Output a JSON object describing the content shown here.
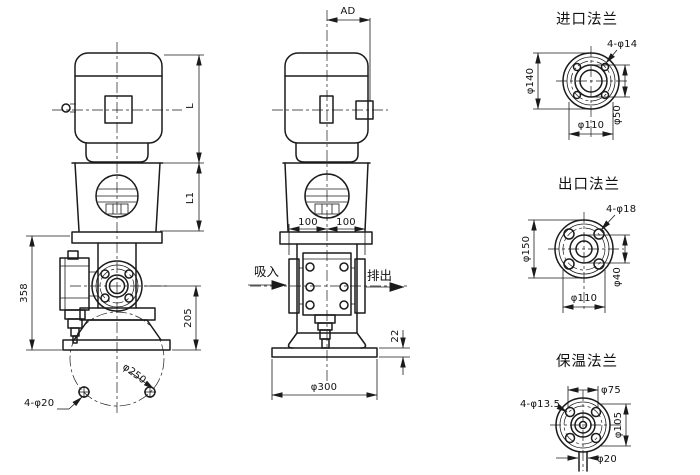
{
  "canvas": {
    "background": "#ffffff",
    "ink": "#1b1b1b"
  },
  "side_view": {
    "dims": {
      "motor_height": "L",
      "bracket_height": "L1",
      "pump_height": "358",
      "port_height": "205",
      "base_bolt_circle": "φ250",
      "base_holes": "4-φ20"
    }
  },
  "front_view": {
    "dims": {
      "motor_offset": "AD",
      "port_span_left": "100",
      "port_span_right": "100",
      "base_plate_thickness": "22",
      "base_diameter": "φ300"
    },
    "flow": {
      "suction": "吸入",
      "discharge": "排出"
    }
  },
  "flange_details": {
    "inlet": {
      "title": "进口法兰",
      "bolt_holes": "4-φ14",
      "outer_diameter": "φ140",
      "face_diameter": "φ50",
      "bolt_circle": "φ110"
    },
    "outlet": {
      "title": "出口法兰",
      "bolt_holes": "4-φ18",
      "outer_diameter": "φ150",
      "face_diameter": "φ40",
      "bolt_circle": "φ110"
    },
    "insulation": {
      "title": "保温法兰",
      "face_diameter": "φ75",
      "bolt_holes": "4-φ13.5",
      "outer_diameter": "φ105",
      "pipe_diameter": "φ20"
    }
  }
}
